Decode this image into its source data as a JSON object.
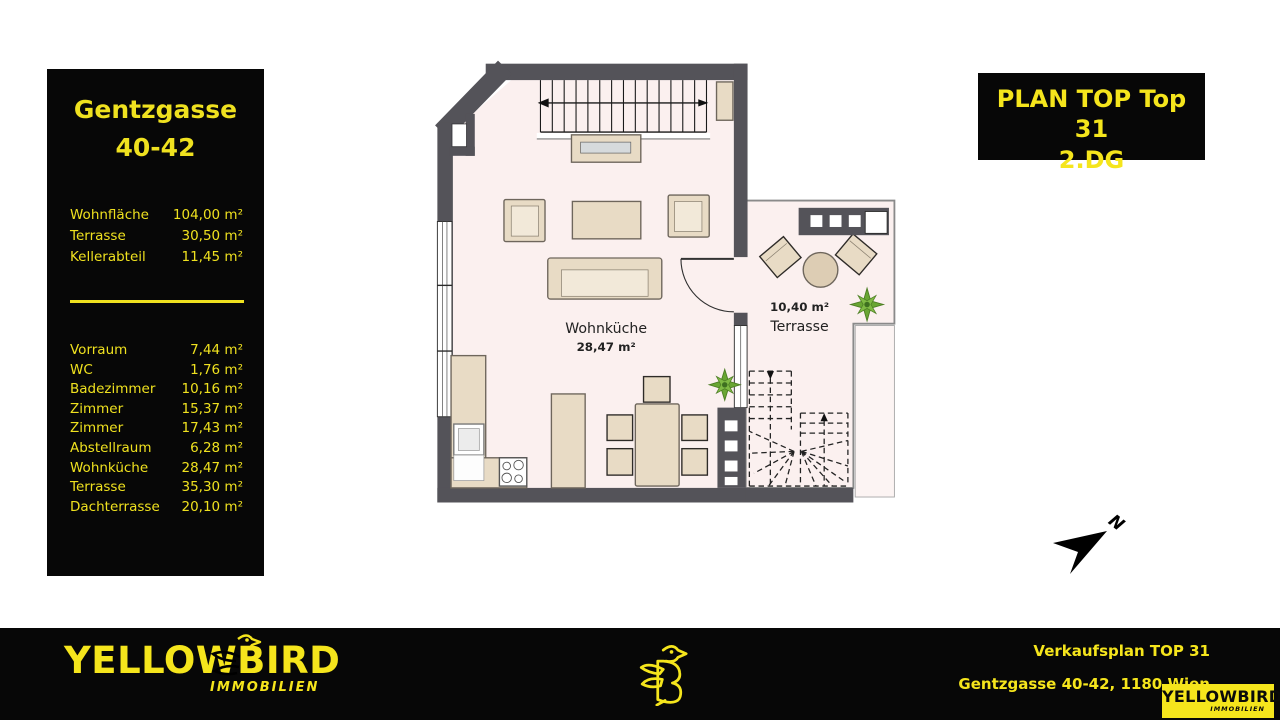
{
  "info_panel": {
    "title_line1": "Gentzgasse",
    "title_line2": "40-42",
    "summary": [
      {
        "label": "Wohnfläche",
        "value": "104,00 m²"
      },
      {
        "label": "Terrasse",
        "value": "30,50 m²"
      },
      {
        "label": "Kellerabteil",
        "value": "11,45 m²"
      }
    ],
    "rooms": [
      {
        "label": "Vorraum",
        "value": "7,44 m²"
      },
      {
        "label": "WC",
        "value": "1,76 m²"
      },
      {
        "label": "Badezimmer",
        "value": "10,16 m²"
      },
      {
        "label": "Zimmer",
        "value": "15,37 m²"
      },
      {
        "label": "Zimmer",
        "value": "17,43 m²"
      },
      {
        "label": "Abstellraum",
        "value": "6,28 m²"
      },
      {
        "label": "Wohnküche",
        "value": "28,47 m²"
      },
      {
        "label": "Terrasse",
        "value": "35,30 m²"
      },
      {
        "label": "Dachterrasse",
        "value": "20,10 m²"
      }
    ]
  },
  "plan_badge": {
    "line1": "PLAN TOP Top 31",
    "line2": "2.DG"
  },
  "floor_plan": {
    "wohnkueche": {
      "name": "Wohnküche",
      "area": "28,47 m²"
    },
    "terrasse": {
      "area": "10,40 m²",
      "name": "Terrasse"
    },
    "compass_label": "N"
  },
  "footer": {
    "brand_start": "YELLOW",
    "brand_bird_letter": "B",
    "brand_end": "IRD",
    "brand_subtitle": "IMMOBILIEN",
    "plan_title": "Verkaufsplan TOP 31",
    "address": "Gentzgasse 40-42, 1180 Wien",
    "small_logo_word": "YELLOWBIRD",
    "small_logo_subtitle": "IMMOBILIEN"
  },
  "colors": {
    "accent_yellow": "#F5E51C",
    "panel_black": "#070707",
    "wall_gray": "#545359",
    "floor_pink": "#FBF0EF",
    "furniture_beige": "#E8DBC5"
  }
}
